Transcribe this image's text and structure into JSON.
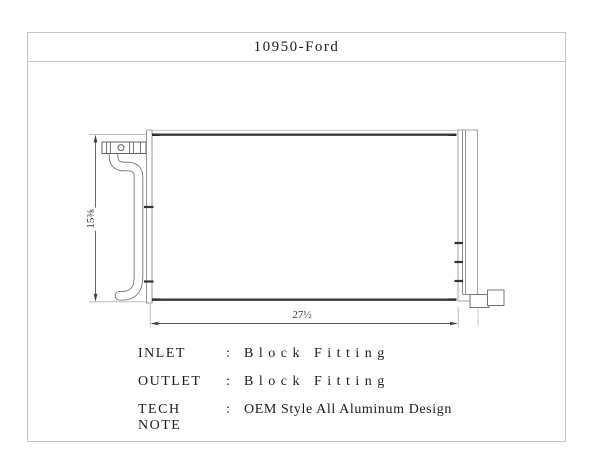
{
  "title": "10950-Ford",
  "drawing": {
    "part": "condenser",
    "height_dim": "15⅜",
    "width_dim": "27½"
  },
  "specs": [
    {
      "label": "INLET",
      "separator": ":",
      "value": "Block Fitting"
    },
    {
      "label": "OUTLET",
      "separator": ":",
      "value": "Block Fitting"
    },
    {
      "label": "TECH NOTE",
      "separator": ":",
      "value": "OEM Style All Aluminum Design"
    }
  ],
  "colors": {
    "background": "#ffffff",
    "frame_border": "#c4c4c4",
    "line_gray": "#8a8a8a",
    "line_dark": "#3a3a3a",
    "dim_line": "#555555",
    "extension_line": "#b8b8b8",
    "text": "#1c1c1c"
  }
}
